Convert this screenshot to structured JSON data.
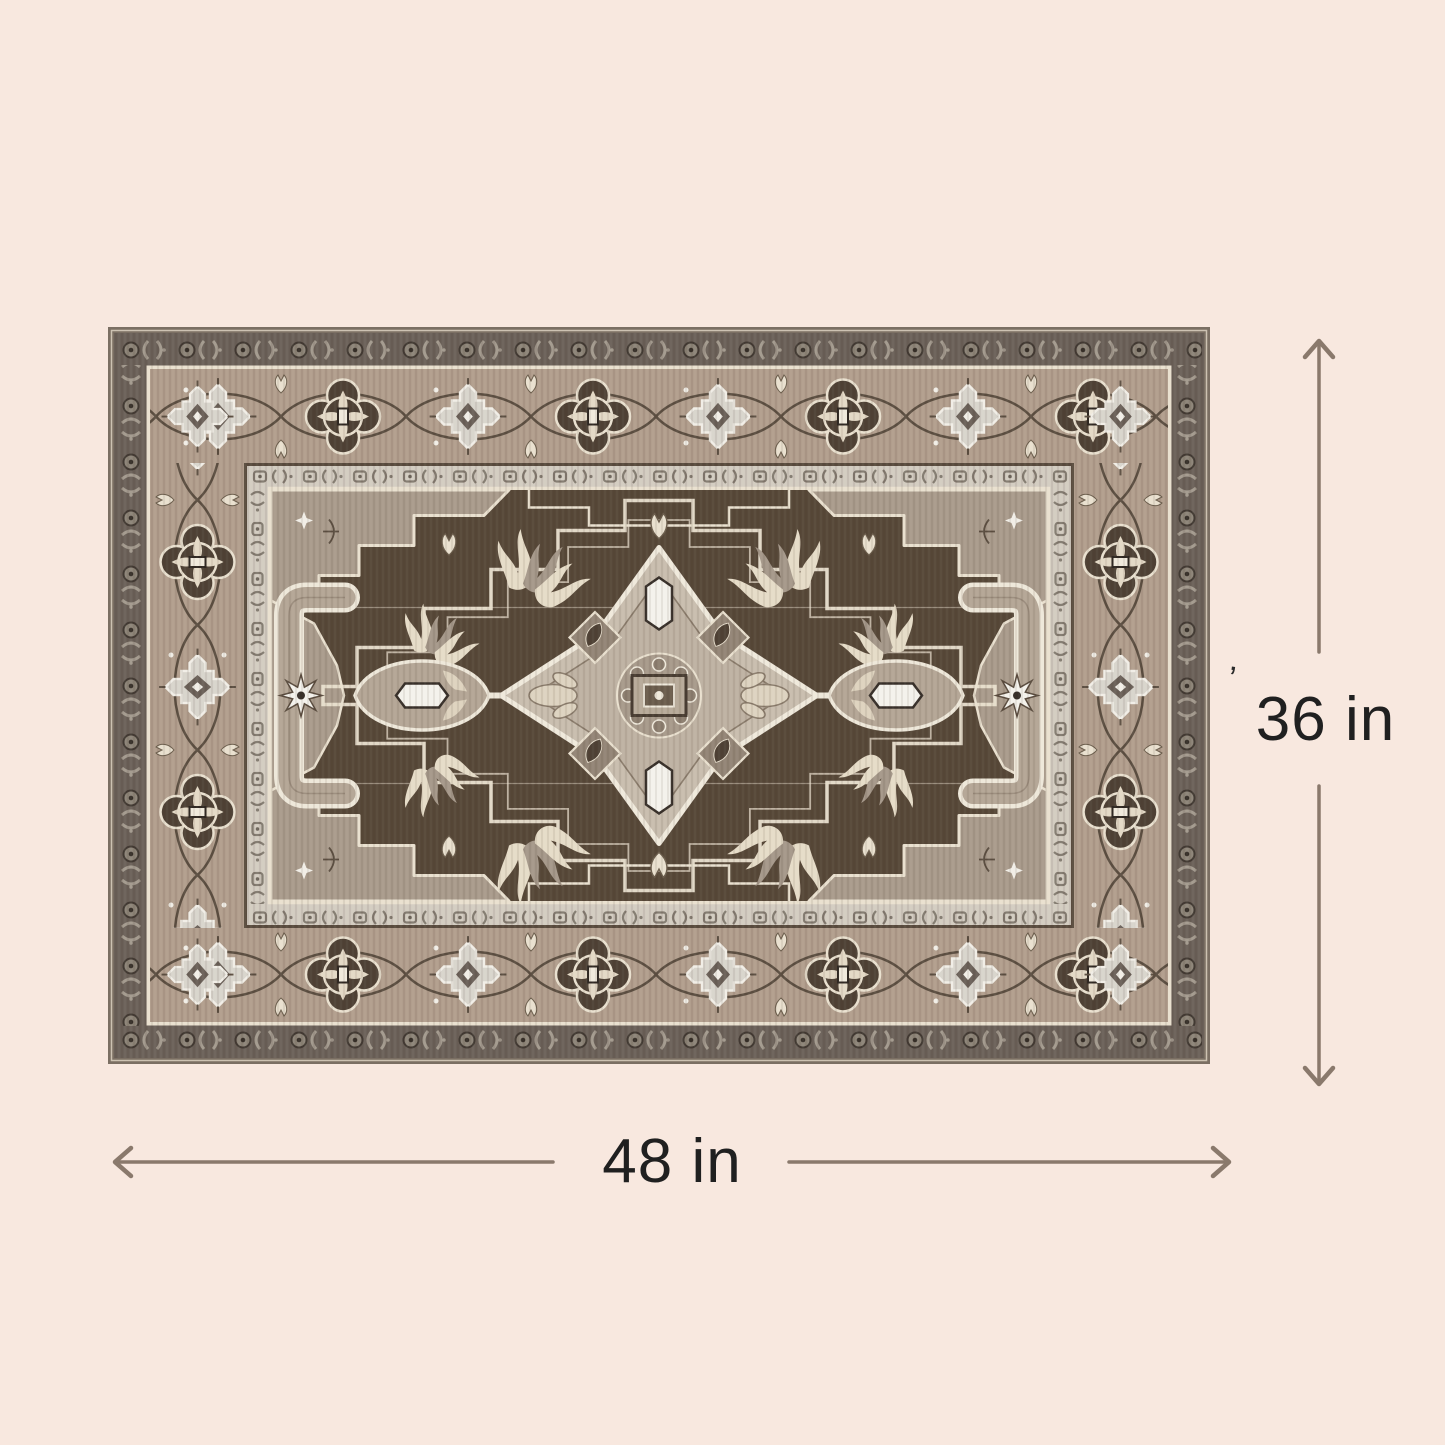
{
  "page": {
    "background_color": "#f8e8df"
  },
  "rug": {
    "description": "Vintage Persian Heriz-style medallion area rug in brown, taupe and cream",
    "colors": {
      "field_brown": "#574839",
      "main_border_tan": "#b19e8d",
      "dark_guard_band": "#6b6159",
      "light_guard_band": "#d3ccc1",
      "cream": "#e9e0cf",
      "ivory": "#f1eee7",
      "accent_dark_brown": "#4f4236",
      "spandrel_taupe": "#a99b8c",
      "medallion_taupe": "#c8bdae"
    }
  },
  "dimensions": {
    "height": {
      "label": "36 in"
    },
    "width": {
      "label": "48 in"
    },
    "arrow_color": "#8a796c",
    "label_color": "#202020",
    "stray_mark": "’"
  }
}
